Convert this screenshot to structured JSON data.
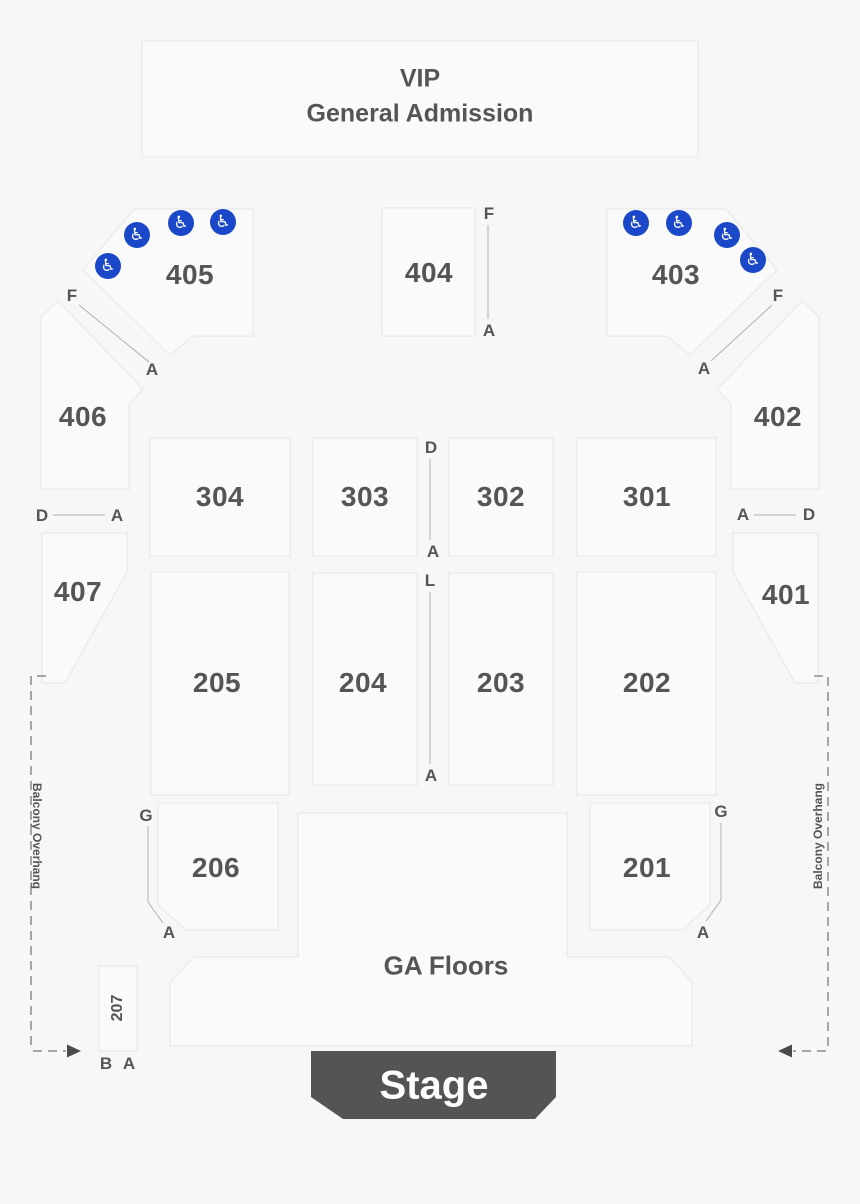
{
  "vip_box": {
    "line1": "VIP",
    "line2": "General Admission"
  },
  "sections": {
    "405": "405",
    "404": "404",
    "403": "403",
    "406": "406",
    "402": "402",
    "407": "407",
    "401": "401",
    "304": "304",
    "303": "303",
    "302": "302",
    "301": "301",
    "205": "205",
    "204": "204",
    "203": "203",
    "202": "202",
    "206": "206",
    "201": "201",
    "207": "207"
  },
  "areas": {
    "ga_floors": "GA Floors",
    "stage": "Stage",
    "balcony_overhang_left": "Balcony Overhang",
    "balcony_overhang_right": "Balcony Overhang"
  },
  "letters": {
    "f": "F",
    "a": "A",
    "d": "D",
    "l": "L",
    "g": "G",
    "b": "B"
  },
  "icons": {
    "wheelchair": "♿"
  },
  "colors": {
    "background": "#f7f7f7",
    "section_fill": "#fafafa",
    "section_border": "#ececec",
    "accessible_blue": "#1a48c8",
    "stage_fill": "#545454",
    "text_gray": "#555555"
  }
}
